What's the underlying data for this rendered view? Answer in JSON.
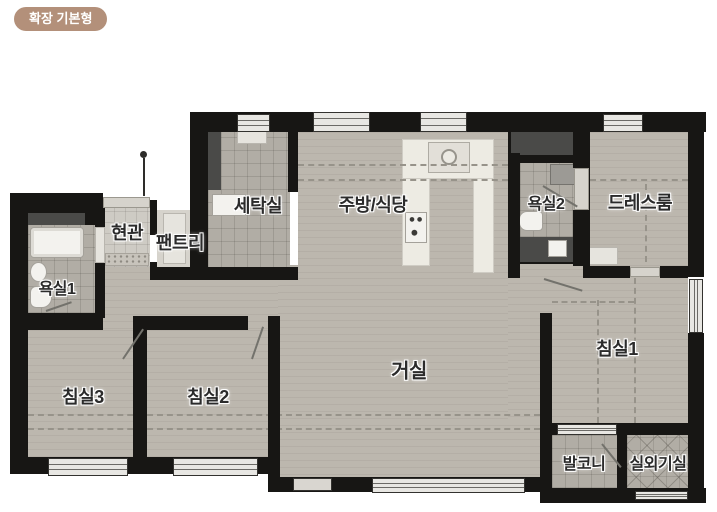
{
  "badge": {
    "label": "확장 기본형"
  },
  "rooms": {
    "laundry": {
      "label": "세탁실"
    },
    "kitchen_dining": {
      "label": "주방/식당"
    },
    "bathroom2": {
      "label": "욕실2"
    },
    "dressroom": {
      "label": "드레스룸"
    },
    "entrance": {
      "label": "현관"
    },
    "pantry": {
      "label": "팬트리"
    },
    "bathroom1": {
      "label": "욕실1"
    },
    "bedroom3": {
      "label": "침실3"
    },
    "bedroom2": {
      "label": "침실2"
    },
    "living": {
      "label": "거실"
    },
    "bedroom1": {
      "label": "침실1"
    },
    "balcony": {
      "label": "발코니"
    },
    "outdoor_unit": {
      "label": "실외기실"
    }
  },
  "colors": {
    "wall": "#171614",
    "wood": "#bcb7ae",
    "tile": "#b1ada5",
    "kitchen": "#edebe3",
    "entry": "#cecbc4",
    "dark": "#4a4a48",
    "win": "#e8e7e3",
    "dash": "#97938a",
    "badge": "#b3907a",
    "label": "#2b2b2b"
  }
}
